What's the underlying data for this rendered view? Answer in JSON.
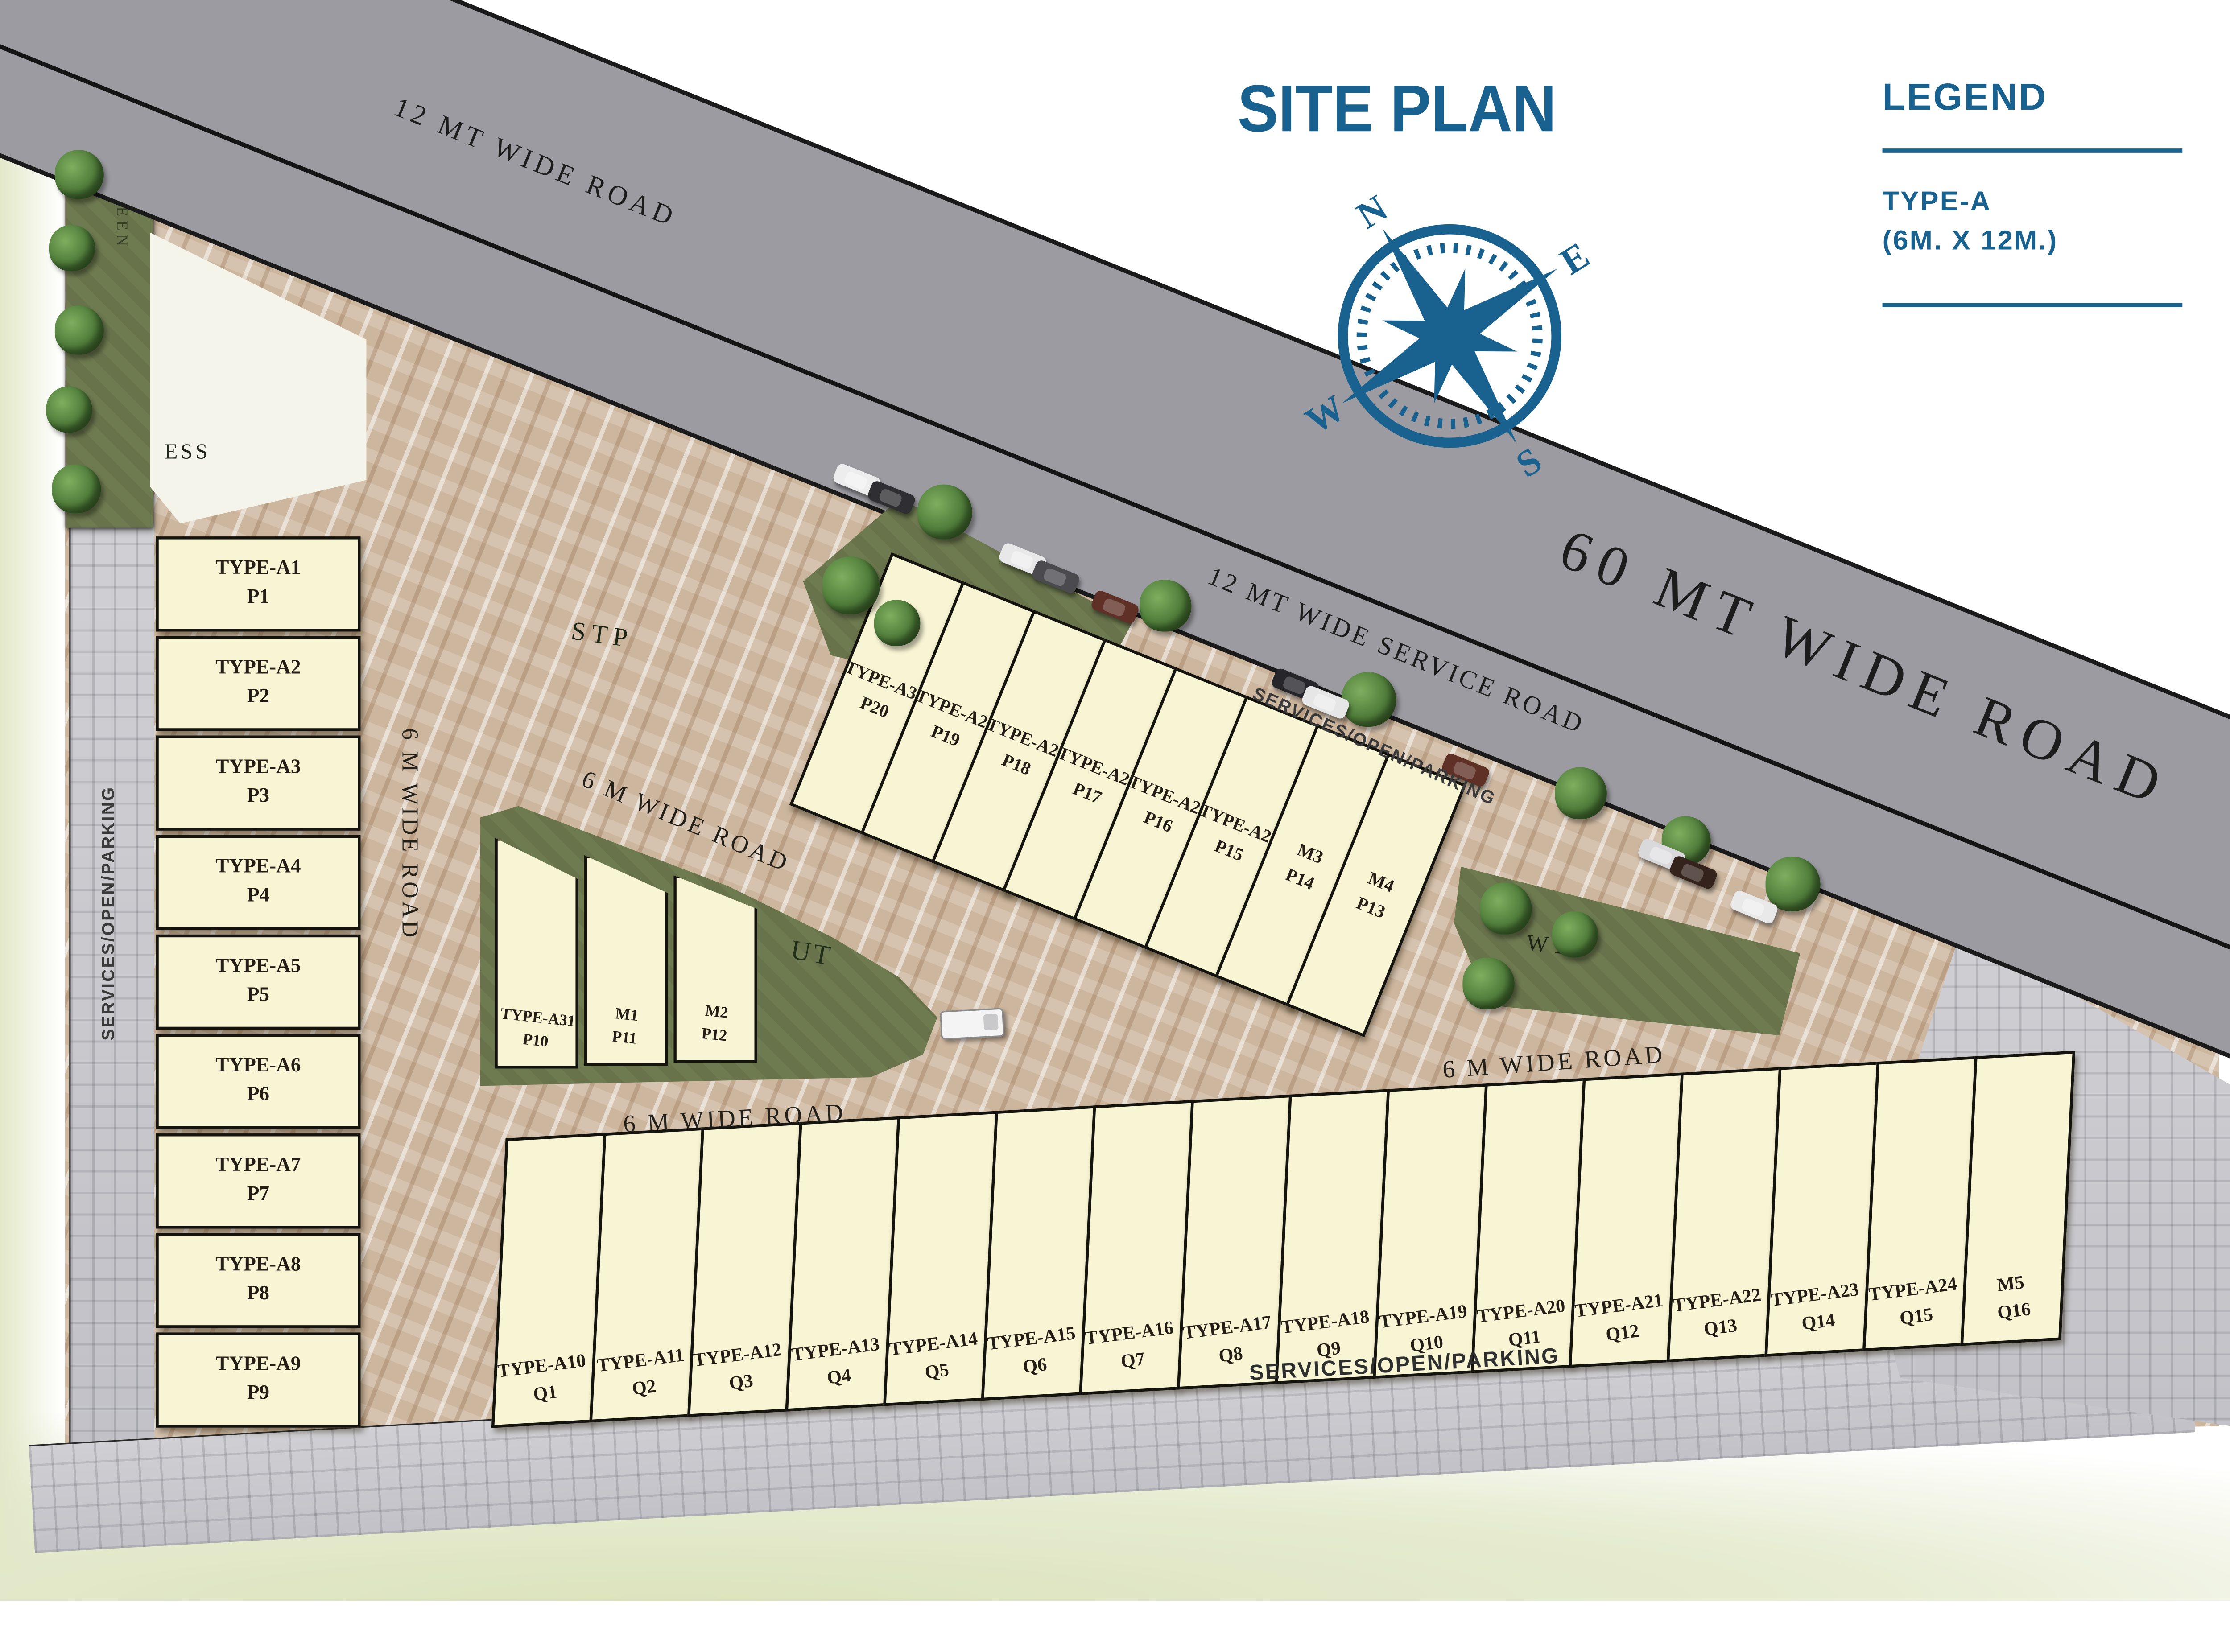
{
  "title": "SITE PLAN",
  "legend": {
    "heading": "LEGEND",
    "items": [
      {
        "label": "TYPE-A",
        "size": "(6M. X 12M.)"
      }
    ]
  },
  "compass": {
    "n": "N",
    "e": "E",
    "s": "S",
    "w": "W"
  },
  "roads": {
    "top_left": "12 MT WIDE ROAD",
    "main": "60 MT WIDE ROAD",
    "service": "12 MT WIDE SERVICE ROAD",
    "six_m": "6 M WIDE ROAD"
  },
  "strips": {
    "services": "SERVICES/OPEN/PARKING"
  },
  "facilities": {
    "ess": "ESS",
    "stp": "STP",
    "wtp": "WTP",
    "ut": "UT",
    "green": "GREEN"
  },
  "plots": {
    "left_column": [
      {
        "type": "TYPE-A1",
        "plot": "P1"
      },
      {
        "type": "TYPE-A2",
        "plot": "P2"
      },
      {
        "type": "TYPE-A3",
        "plot": "P3"
      },
      {
        "type": "TYPE-A4",
        "plot": "P4"
      },
      {
        "type": "TYPE-A5",
        "plot": "P5"
      },
      {
        "type": "TYPE-A6",
        "plot": "P6"
      },
      {
        "type": "TYPE-A7",
        "plot": "P7"
      },
      {
        "type": "TYPE-A8",
        "plot": "P8"
      },
      {
        "type": "TYPE-A9",
        "plot": "P9"
      }
    ],
    "upper_row": [
      {
        "type": "TYPE-A30",
        "plot": "P20"
      },
      {
        "type": "TYPE-A29",
        "plot": "P19"
      },
      {
        "type": "TYPE-A28",
        "plot": "P18"
      },
      {
        "type": "TYPE-A27",
        "plot": "P17"
      },
      {
        "type": "TYPE-A26",
        "plot": "P16"
      },
      {
        "type": "TYPE-A25",
        "plot": "P15"
      },
      {
        "type": "M3",
        "plot": "P14"
      },
      {
        "type": "M4",
        "plot": "P13"
      }
    ],
    "island_row": [
      {
        "type": "TYPE-A31",
        "plot": "P10"
      },
      {
        "type": "M1",
        "plot": "P11"
      },
      {
        "type": "M2",
        "plot": "P12"
      }
    ],
    "bottom_row": [
      {
        "type": "TYPE-A10",
        "plot": "Q1"
      },
      {
        "type": "TYPE-A11",
        "plot": "Q2"
      },
      {
        "type": "TYPE-A12",
        "plot": "Q3"
      },
      {
        "type": "TYPE-A13",
        "plot": "Q4"
      },
      {
        "type": "TYPE-A14",
        "plot": "Q5"
      },
      {
        "type": "TYPE-A15",
        "plot": "Q6"
      },
      {
        "type": "TYPE-A16",
        "plot": "Q7"
      },
      {
        "type": "TYPE-A17",
        "plot": "Q8"
      },
      {
        "type": "TYPE-A18",
        "plot": "Q9"
      },
      {
        "type": "TYPE-A19",
        "plot": "Q10"
      },
      {
        "type": "TYPE-A20",
        "plot": "Q11"
      },
      {
        "type": "TYPE-A21",
        "plot": "Q12"
      },
      {
        "type": "TYPE-A22",
        "plot": "Q13"
      },
      {
        "type": "TYPE-A23",
        "plot": "Q14"
      },
      {
        "type": "TYPE-A24",
        "plot": "Q15"
      },
      {
        "type": "M5",
        "plot": "Q16"
      }
    ]
  },
  "colors": {
    "accent_blue": "#19618e",
    "plot_fill": "#f8f5d4",
    "road_gray": "#9b9ba1",
    "ground_tan": "#cdb69e",
    "green_olive": "#6e7a50",
    "tile_gray": "#c8c8cc"
  }
}
